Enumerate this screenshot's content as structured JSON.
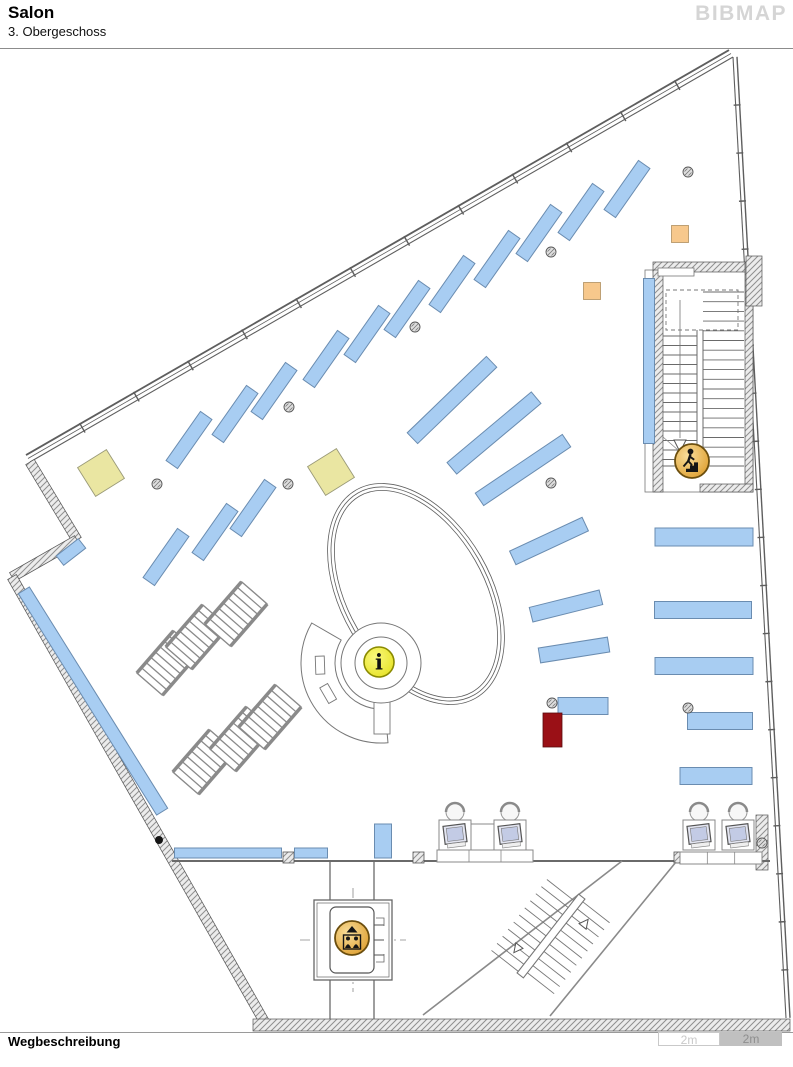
{
  "header": {
    "title": "Salon",
    "subtitle": "3. Obergeschoss",
    "logo": "BIBMAP"
  },
  "footer": {
    "label": "Wegbeschreibung",
    "scale_segments": [
      {
        "label": "2m",
        "variant": "light"
      },
      {
        "label": "2m",
        "variant": "dark"
      }
    ]
  },
  "colors": {
    "shelf_fill": "#A8CDF2",
    "shelf_stroke": "#6A8CB0",
    "yellow": "#EAE6A2",
    "orange": "#F7C88C",
    "red": "#9A1016",
    "amber_dark": "#6B4E0E",
    "info_ring": "#8A8A00",
    "line": "#666666",
    "wall_edge": "#555555"
  },
  "map": {
    "walls": {
      "window_wall": {
        "x1": 30,
        "y1": 462,
        "x2": 733,
        "y2": 57,
        "ticks": 13
      },
      "right_wall": {
        "x1": 733,
        "y1": 57,
        "x2": 786,
        "y2": 1018,
        "ticks": 20
      },
      "hatched_polyline": {
        "pts": [
          [
            30,
            462
          ],
          [
            77,
            540
          ],
          [
            12,
            577
          ],
          [
            265,
            1023
          ]
        ],
        "w": 10
      },
      "bottom_wall": {
        "x": 253,
        "y": 1019,
        "w": 537,
        "h": 12
      },
      "interior_wall": {
        "x1": 172,
        "y1": 861,
        "x2": 770,
        "y2": 861
      },
      "wall_stubs": [
        [
          283,
          852
        ],
        [
          413,
          852
        ],
        [
          674,
          852
        ]
      ],
      "right_wall_hatch": {
        "x": 756,
        "y": 815,
        "w": 12,
        "h": 55
      }
    },
    "shelves": [
      [
        326,
        359,
        60,
        14,
        -55
      ],
      [
        367,
        334,
        60,
        14,
        -55
      ],
      [
        407,
        309,
        60,
        14,
        -55
      ],
      [
        452,
        284,
        60,
        14,
        -55
      ],
      [
        497,
        259,
        60,
        14,
        -55
      ],
      [
        539,
        233,
        60,
        14,
        -55
      ],
      [
        581,
        212,
        60,
        14,
        -55
      ],
      [
        627,
        189,
        60,
        14,
        -55
      ],
      [
        189,
        440,
        60,
        14,
        -55
      ],
      [
        235,
        414,
        60,
        14,
        -55
      ],
      [
        274,
        391,
        60,
        14,
        -55
      ],
      [
        166,
        557,
        60,
        14,
        -55
      ],
      [
        215,
        532,
        60,
        14,
        -55
      ],
      [
        253,
        508,
        60,
        14,
        -55
      ],
      [
        452,
        400,
        110,
        15,
        -44
      ],
      [
        494,
        433,
        110,
        15,
        -40
      ],
      [
        523,
        470,
        105,
        15,
        -34
      ],
      [
        549,
        541,
        80,
        15,
        -25
      ],
      [
        566,
        606,
        72,
        15,
        -14
      ],
      [
        574,
        650,
        70,
        15,
        -9
      ],
      [
        583,
        706,
        50,
        17,
        0
      ],
      [
        704,
        537,
        98,
        18,
        0
      ],
      [
        703,
        610,
        97,
        17,
        0
      ],
      [
        704,
        666,
        98,
        17,
        0
      ],
      [
        720,
        721,
        65,
        17,
        0
      ],
      [
        716,
        776,
        72,
        17,
        0
      ],
      [
        649,
        361,
        165,
        11,
        90
      ],
      [
        228,
        853,
        107,
        10,
        0
      ],
      [
        311,
        853,
        33,
        10,
        0
      ],
      [
        383,
        841,
        34,
        17,
        90
      ],
      [
        93,
        701,
        261,
        13,
        58
      ],
      [
        71,
        552,
        28,
        12,
        -38
      ]
    ],
    "compact_shelving": {
      "len": 56,
      "wid": 34,
      "rungs": 8,
      "units": [
        [
          168,
          663,
          -49
        ],
        [
          197,
          637,
          -49
        ],
        [
          236,
          614,
          -49
        ],
        [
          204,
          762,
          -49
        ],
        [
          241,
          739,
          -49
        ],
        [
          270,
          717,
          -49
        ]
      ]
    },
    "yellow_squares": [
      {
        "cx": 101,
        "cy": 473,
        "size": 34,
        "deg": -32
      },
      {
        "cx": 331,
        "cy": 472,
        "size": 34,
        "deg": -32
      }
    ],
    "orange_squares": [
      {
        "cx": 592,
        "cy": 291,
        "size": 17
      },
      {
        "cx": 680,
        "cy": 234,
        "size": 17
      }
    ],
    "red_rect": {
      "x": 543,
      "y": 713,
      "w": 19,
      "h": 34
    },
    "columns": [
      [
        157,
        484
      ],
      [
        288,
        484
      ],
      [
        289,
        407
      ],
      [
        415,
        327
      ],
      [
        551,
        252
      ],
      [
        688,
        172
      ],
      [
        551,
        483
      ],
      [
        552,
        703
      ],
      [
        688,
        708
      ],
      [
        762,
        843
      ]
    ],
    "door_pivot": [
      159,
      840
    ],
    "ellipse_ramp": {
      "cx": 416,
      "cy": 594,
      "rx": 75,
      "ry": 120,
      "deg": -30
    },
    "info_desk": {
      "cx": 381,
      "cy": 663,
      "r_outer": 40,
      "r_inner": 26,
      "fan": {
        "r1": 46,
        "r2": 80,
        "a1": 85,
        "a2": 210
      },
      "tail": {
        "x": 374,
        "y": 688,
        "w": 16,
        "h": 46
      }
    },
    "stairwell": {
      "x": 645,
      "y": 262,
      "w": 108,
      "h": 230
    },
    "elevator": {
      "x": 314,
      "y": 900,
      "w": 78,
      "h": 80
    },
    "bottom_stairs": {
      "lines": [
        [
          423,
          1015,
          622,
          861
        ],
        [
          550,
          1016,
          676,
          862
        ]
      ],
      "cx": 551,
      "cy": 936,
      "deg": -52,
      "len": 100,
      "wid": 76
    },
    "workstations": {
      "group1": {
        "desks": [
          [
            439,
            820
          ],
          [
            494,
            820
          ]
        ],
        "table": [
          471,
          824,
          23,
          26
        ],
        "chairs": [
          [
            455,
            812
          ],
          [
            510,
            812
          ]
        ],
        "platform": [
          437,
          850,
          96,
          12
        ]
      },
      "group2": {
        "desks": [
          [
            683,
            820
          ],
          [
            722,
            820
          ]
        ],
        "table": null,
        "chairs": [
          [
            701,
            810
          ],
          [
            740,
            810
          ]
        ],
        "platform": [
          680,
          852,
          82,
          12
        ]
      }
    },
    "icons": {
      "info": {
        "x": 379,
        "y": 662,
        "r": 15
      },
      "stairs": {
        "x": 692,
        "y": 461,
        "r": 17
      },
      "elevator": {
        "x": 352,
        "y": 938,
        "r": 17
      }
    }
  }
}
